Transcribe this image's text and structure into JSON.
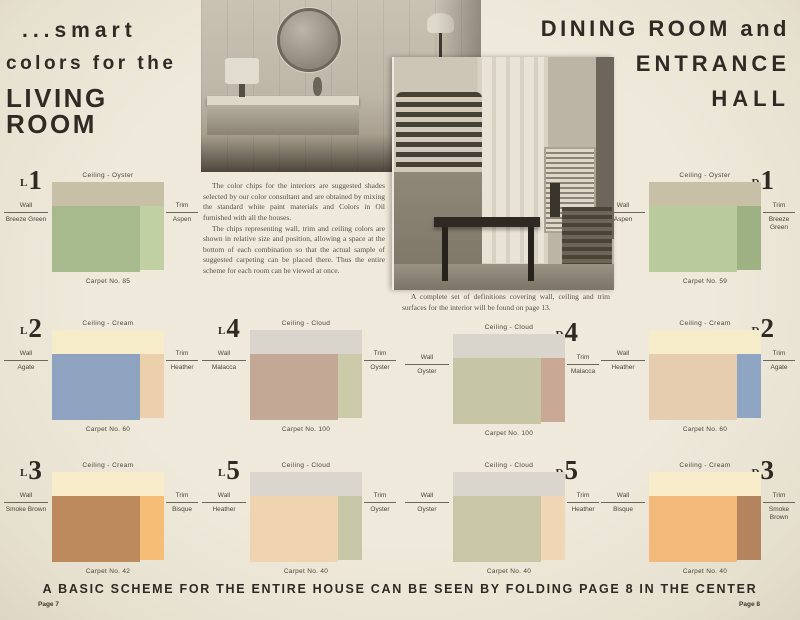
{
  "titles": {
    "left": [
      "...smart",
      "colors for the",
      "LIVING ROOM"
    ],
    "right": [
      "DINING ROOM and",
      "ENTRANCE",
      "HALL"
    ]
  },
  "body": {
    "p1": "The color chips for the interiors are suggested shades selected by our color consultant and are obtained by mixing the standard white paint materials and Colors in Oil furnished with all the houses.",
    "p2": "The chips representing wall, trim and ceiling colors are shown in relative size and position, allowing a space at the bottom of each combination so that the actual sample of suggested carpeting can be placed there. Thus the entire scheme for each room can be viewed at once.",
    "photo_caption": "A complete set of definitions covering wall, ceiling and trim surfaces for the interior will be found on page 13."
  },
  "labels": {
    "wall": "Wall",
    "trim": "Trim"
  },
  "panels": [
    {
      "id": "L1",
      "num_side": "left",
      "ceiling_caption": "Ceiling - Oyster",
      "wall": "Breeze Green",
      "trim": "Aspen",
      "carpet": "Carpet No. 85",
      "colors": {
        "ceiling": "#c8c0a6",
        "wall": "#a6ba8d",
        "trim": "#c0d0a2"
      }
    },
    {
      "id": "D1",
      "num_side": "right",
      "ceiling_caption": "Ceiling - Oyster",
      "wall": "Aspen",
      "trim": "Breeze Green",
      "carpet": "Carpet No. 59",
      "colors": {
        "ceiling": "#c8c0a6",
        "wall": "#b9cb9c",
        "trim": "#9db183"
      }
    },
    {
      "id": "L2",
      "num_side": "left",
      "ceiling_caption": "Ceiling - Cream",
      "wall": "Agate",
      "trim": "Heather",
      "carpet": "Carpet No. 60",
      "colors": {
        "ceiling": "#f7ecca",
        "wall": "#8ea3c0",
        "trim": "#ecd0ab"
      }
    },
    {
      "id": "L4",
      "num_side": "left",
      "ceiling_caption": "Ceiling - Cloud",
      "wall": "Malacca",
      "trim": "Oyster",
      "carpet": "Carpet No. 100",
      "colors": {
        "ceiling": "#dad5cc",
        "wall": "#c4a896",
        "trim": "#cbcbaa"
      }
    },
    {
      "id": "D4",
      "num_side": "right",
      "ceiling_caption": "Ceiling - Cloud",
      "wall": "Oyster",
      "trim": "Malacca",
      "carpet": "Carpet No. 100",
      "colors": {
        "ceiling": "#dad5cc",
        "wall": "#c6c5a6",
        "trim": "#c9a995"
      }
    },
    {
      "id": "D2",
      "num_side": "right",
      "ceiling_caption": "Ceiling - Cream",
      "wall": "Heather",
      "trim": "Agate",
      "carpet": "Carpet No. 60",
      "colors": {
        "ceiling": "#f7ecca",
        "wall": "#e6cdb0",
        "trim": "#8fa5c4"
      }
    },
    {
      "id": "L3",
      "num_side": "left",
      "ceiling_caption": "Ceiling - Cream",
      "wall": "Smoke Brown",
      "trim": "Bisque",
      "carpet": "Carpet No. 42",
      "colors": {
        "ceiling": "#f8eccb",
        "wall": "#bd8a5d",
        "trim": "#f6bd77"
      }
    },
    {
      "id": "L5",
      "num_side": "left",
      "ceiling_caption": "Ceiling - Cloud",
      "wall": "Heather",
      "trim": "Oyster",
      "carpet": "Carpet No. 40",
      "colors": {
        "ceiling": "#dbd6cd",
        "wall": "#f0d4b0",
        "trim": "#c6c7a7"
      }
    },
    {
      "id": "D5",
      "num_side": "right",
      "ceiling_caption": "Ceiling - Cloud",
      "wall": "Oyster",
      "trim": "Heather",
      "carpet": "Carpet No. 40",
      "colors": {
        "ceiling": "#dbd6cd",
        "wall": "#c9c6a8",
        "trim": "#f0d6b4"
      }
    },
    {
      "id": "D3",
      "num_side": "right",
      "ceiling_caption": "Ceiling - Cream",
      "wall": "Bisque",
      "trim": "Smoke Brown",
      "carpet": "Carpet No. 40",
      "colors": {
        "ceiling": "#f8eccb",
        "wall": "#f3b97a",
        "trim": "#b3845e"
      }
    }
  ],
  "footer": {
    "banner": "A BASIC SCHEME FOR THE ENTIRE HOUSE CAN BE SEEN BY FOLDING PAGE 8 IN THE CENTER",
    "page_left": "Page 7",
    "page_right": "Page 8"
  }
}
